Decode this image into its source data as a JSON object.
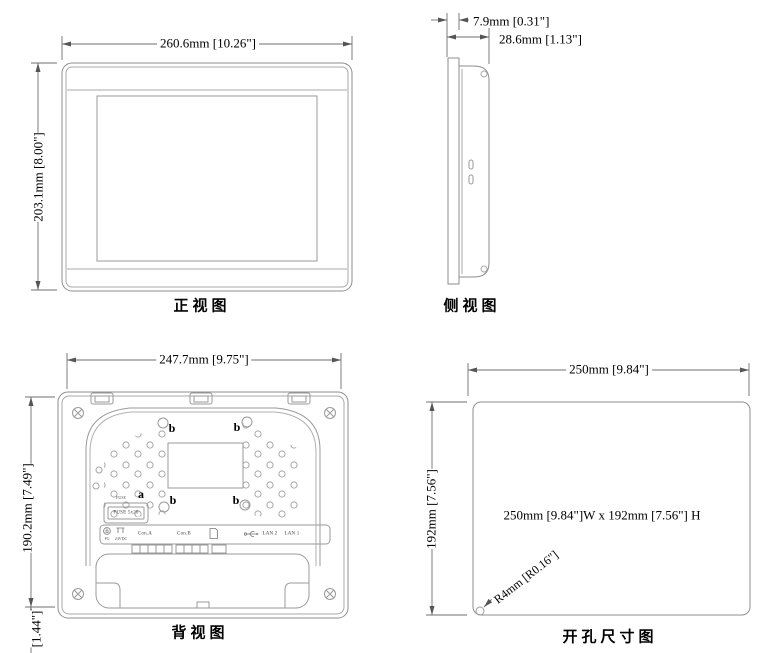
{
  "drawing": {
    "colors": {
      "object_line": "#8e8e8e",
      "dimension_line": "#6f6f6f",
      "text": "#000000",
      "background": "#ffffff"
    },
    "icons": {
      "ground_icon": "protective-earth-symbol",
      "power_icon": "dc-power-pins",
      "sd_icon": "sd-card",
      "usb_icon": "usb-trident"
    },
    "views": {
      "front": {
        "title": "正视图",
        "dim_width": "260.6mm [10.26\"]",
        "dim_height": "203.1mm [8.00\"]"
      },
      "side": {
        "title": "侧视图",
        "dim_bezel": "7.9mm [0.31\"]",
        "dim_depth": "28.6mm [1.13\"]"
      },
      "back": {
        "title": "背视图",
        "dim_width": "247.7mm [9.75\"]",
        "dim_height": "190.2mm [7.49\"]",
        "dim_bottom": "[1.44\"]",
        "label_a": "a",
        "label_b": "b",
        "fuse_caption": "FUSE",
        "fuse_box": "FUSE 5x20",
        "port_fg": "FG",
        "port_power": "24VDC",
        "port_con_a": "Con.A",
        "port_con_b": "Con.B",
        "port_lan2": "LAN 2",
        "port_lan1": "LAN 1"
      },
      "cutout": {
        "title": "开孔尺寸图",
        "dim_width": "250mm [9.84\"]",
        "dim_height": "192mm [7.56\"]",
        "center_note": "250mm [9.84\"]W x 192mm [7.56\"] H",
        "radius_note": "R4mm [R0.16\"]"
      }
    }
  }
}
